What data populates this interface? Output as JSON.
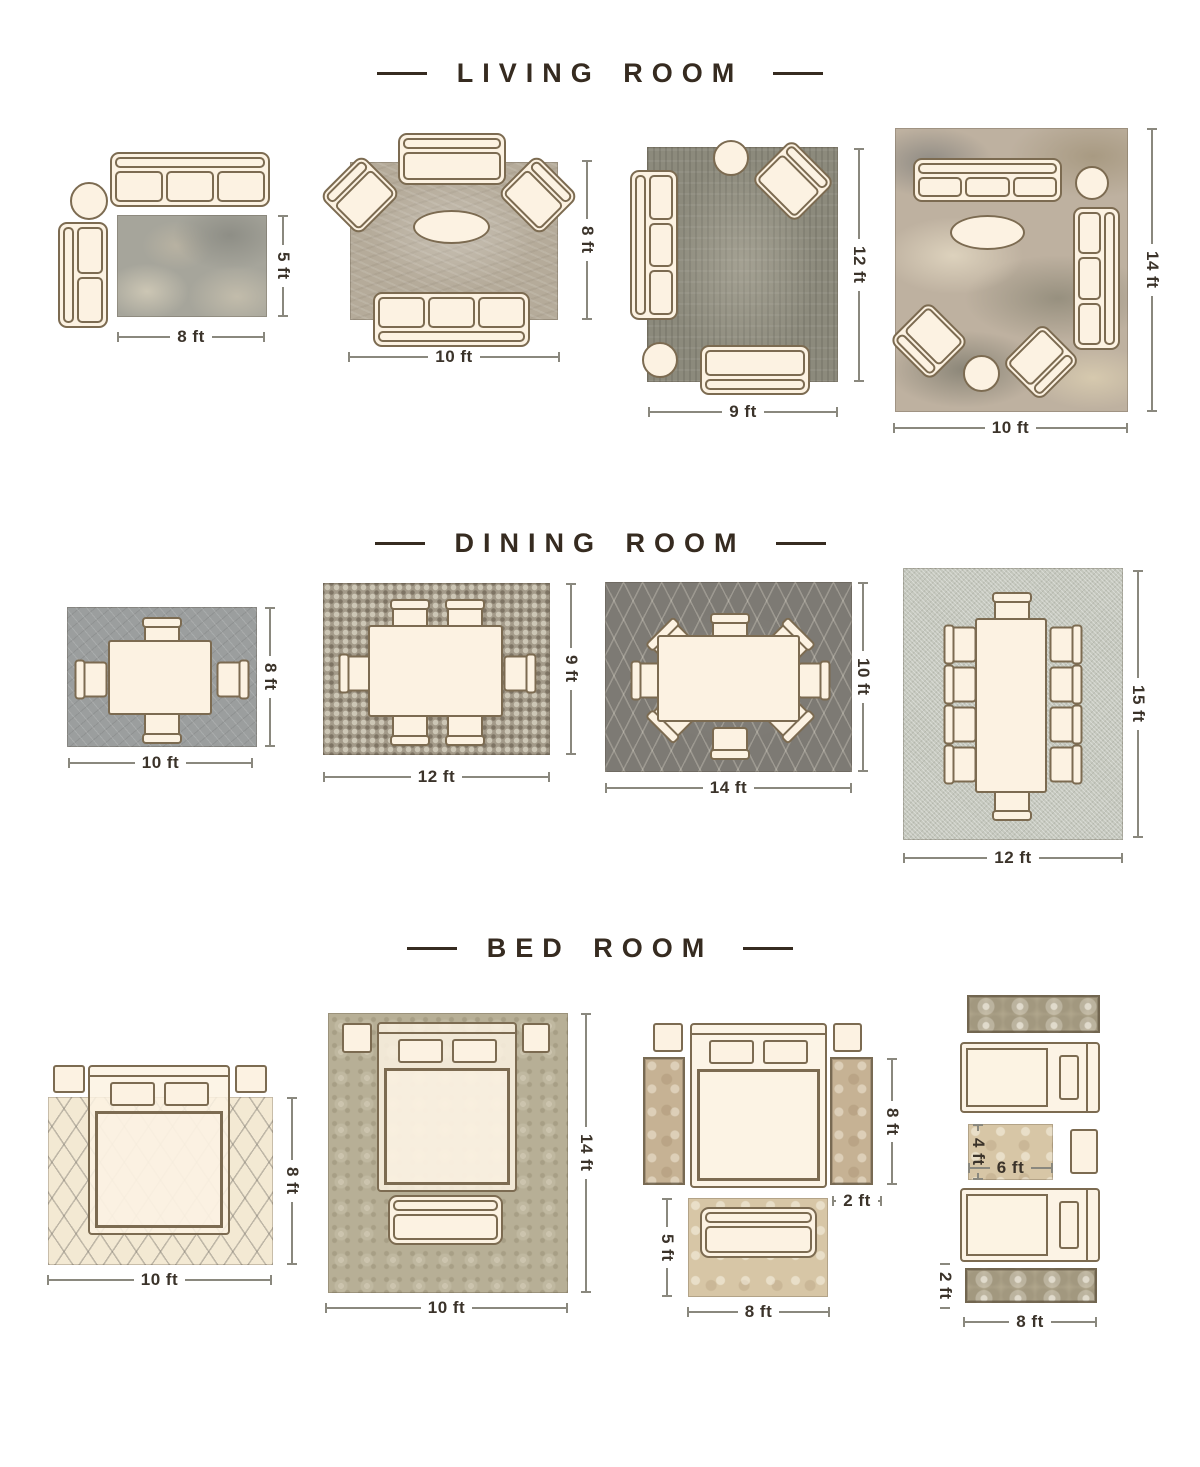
{
  "palette": {
    "furniture_fill": "#fcf2e2",
    "furniture_outline": "#7c6b51",
    "title_text": "#362b20",
    "dimension_text": "#3b332a",
    "dimension_line": "#8a887e"
  },
  "sections": [
    {
      "title": "LIVING ROOM",
      "layouts": [
        {
          "name": "sofa-and-chaise",
          "rug_width": "8 ft",
          "rug_height": "5 ft"
        },
        {
          "name": "sofa-two-armchairs",
          "rug_width": "10 ft",
          "rug_height": "8 ft"
        },
        {
          "name": "sofa-loveseat-armchair",
          "rug_width": "9 ft",
          "rug_height": "12 ft"
        },
        {
          "name": "two-sofas-two-armchairs",
          "rug_width": "10 ft",
          "rug_height": "14 ft"
        }
      ]
    },
    {
      "title": "DINING ROOM",
      "layouts": [
        {
          "name": "table-four-chairs",
          "rug_width": "10 ft",
          "rug_height": "8 ft"
        },
        {
          "name": "table-six-chairs",
          "rug_width": "12 ft",
          "rug_height": "9 ft"
        },
        {
          "name": "oval-table-eight-chairs",
          "rug_width": "14 ft",
          "rug_height": "10 ft"
        },
        {
          "name": "table-ten-chairs",
          "rug_width": "12 ft",
          "rug_height": "15 ft"
        }
      ]
    },
    {
      "title": "BED ROOM",
      "layouts": [
        {
          "name": "queen-bed-full-rug",
          "rug_width": "10 ft",
          "rug_height": "8 ft"
        },
        {
          "name": "bed-and-bench-full-rug",
          "rug_width": "10 ft",
          "rug_height": "14 ft"
        },
        {
          "name": "bed-side-runners-foot-rug",
          "runner_height": "8 ft",
          "runner_width": "2 ft",
          "foot_rug_height": "5 ft",
          "foot_rug_width": "8 ft"
        },
        {
          "name": "twin-beds-runners-center-rug",
          "center_rug_height": "4 ft",
          "center_rug_width": "6 ft",
          "runner_width": "2 ft",
          "runner_length": "8 ft"
        }
      ]
    }
  ]
}
